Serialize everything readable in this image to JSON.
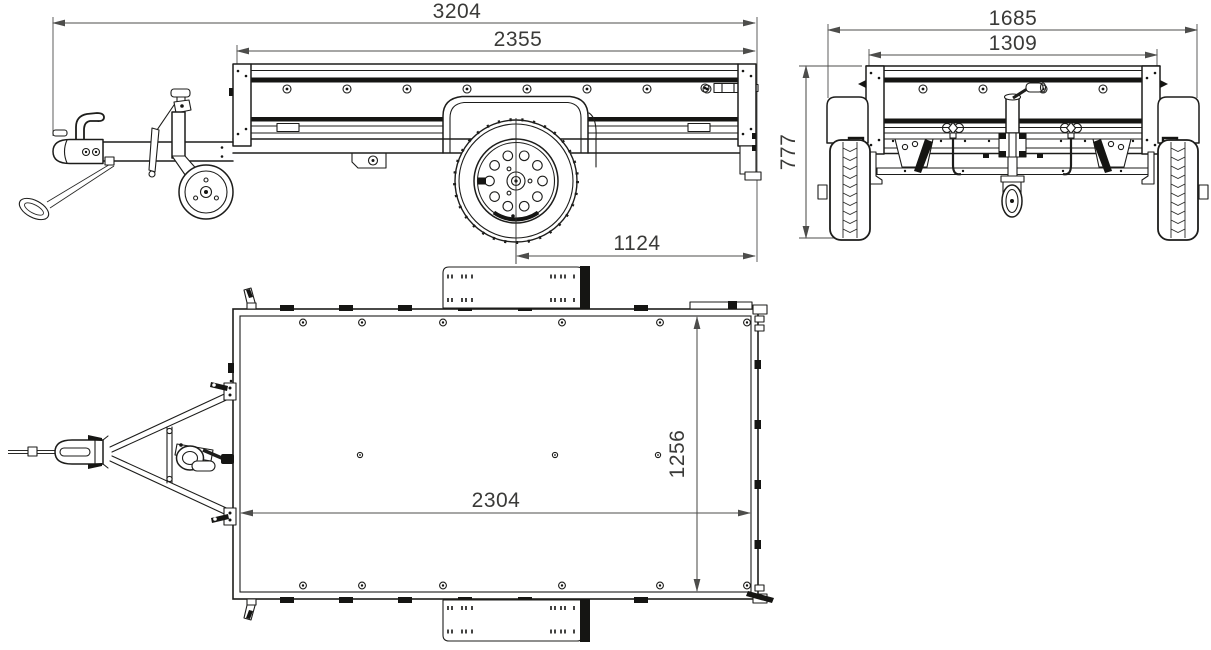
{
  "page": {
    "background": "#ffffff"
  },
  "drawing": {
    "subject": "box-trailer three-view technical drawing",
    "line_color": "#1d1d1b",
    "dim_line_color": "#4d4d4b",
    "views": {
      "side": "side view",
      "front": "front view",
      "top": "top view"
    },
    "dims": {
      "overall_length": "3204",
      "box_outer_length": "2355",
      "axle_to_rear": "1124",
      "overall_width": "1685",
      "box_outer_width": "1309",
      "overall_height": "777",
      "inner_length": "2304",
      "inner_width": "1256"
    }
  }
}
